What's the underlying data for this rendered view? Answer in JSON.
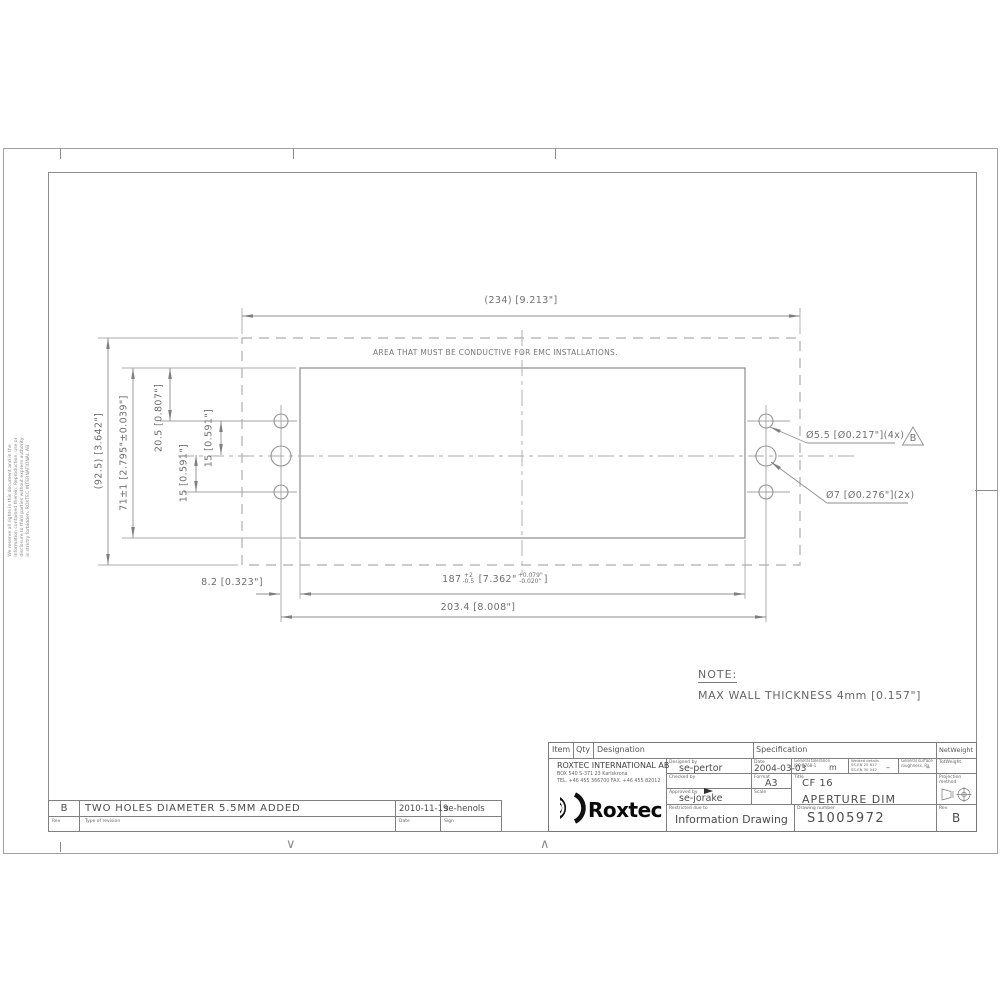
{
  "sheet": {
    "copyright": [
      "We reserve all rights in this document and in the",
      "information contained therein. Reproduction, use or",
      "disclosure to third parties without express authority",
      "is strictly forbidden.  ROXTEC INTERNATIONAL AB"
    ],
    "fold_mark_down": "∨",
    "fold_mark_up": "∧"
  },
  "drawing": {
    "emc_area_label": "AREA THAT MUST BE CONDUCTIVE FOR EMC INSTALLATIONS.",
    "dim_width_ref": "(234) [9.213\"]",
    "dim_height_ref": "(92.5) [3.642\"]",
    "dim_aperture_height": "71±1 [2.795\"±0.039\"]",
    "dim_hole_top_offset": "20.5 [0.807\"]",
    "dim_hole_pitch_upper": "15 [0.591\"]",
    "dim_hole_pitch_lower": "15 [0.591\"]",
    "dim_hole_edge": "8.2 [0.323\"]",
    "dim_aperture_width": {
      "main": "187",
      "plus": "+2",
      "minus": "-0.5",
      "inch": "[7.362\"",
      "inch_plus": "+0.079\"",
      "inch_minus": "-0.020\"",
      "close": "]"
    },
    "dim_hole_spacing": "203.4 [8.008\"]",
    "label_small_holes": "Ø5.5 [Ø0.217\"](4x)",
    "label_large_holes": "Ø7  [Ø0.276\"](2x)",
    "revision_flag": "B",
    "note_title": "NOTE:",
    "note_body": "MAX WALL THICKNESS  4mm [0.157\"]"
  },
  "revision_table": {
    "rev_value": "B",
    "description": "TWO HOLES DIAMETER 5.5MM ADDED",
    "date_value": "2010-11-19",
    "sign_value": "se-henols",
    "rev_label": "Rev",
    "type_label": "Type of revision",
    "date_label": "Date",
    "sign_label": "Sign"
  },
  "title_block": {
    "header_item": "Item",
    "header_qty": "Qty",
    "header_designation": "Designation",
    "header_specification": "Specification",
    "header_netweight": "NetWeight",
    "company_name": "ROXTEC INTERNATIONAL AB",
    "company_address": "BOX 540   S-371 23 Karlskrona",
    "company_phone": "TEL. +46 455 366700   FAX. +46 455 82012",
    "logo_text": "Roxtec",
    "designed_label": "Designed by",
    "designed_value": "se-pertor",
    "checked_label": "Checked by",
    "checked_value": "",
    "approved_label": "Approved by",
    "approved_value": "se-jorake",
    "restricted_label": "Restricted due to",
    "restricted_value": "Information Drawing",
    "date_label": "Date",
    "date_value": "2004-03-03",
    "format_label": "Format",
    "format_value": "A3",
    "scale_label": "Scale",
    "scale_value": "",
    "gentol_label1": "General tolerance",
    "gentol_label2": "ISO 2768-1",
    "gentol_value": "m",
    "weld_label1": "Welded details",
    "weld_label2": "SS-EN 25 817",
    "weld_label3": "SS-EN 30 042",
    "weld_value": "–",
    "surf_label1": "General surface",
    "surf_label2": "roughness, Ra",
    "surf_value": "–",
    "title_label": "Title",
    "title_line1": "CF 16",
    "title_line2": "APERTURE DIM",
    "drawingno_label": "Drawing number",
    "drawingno_value": "S1005972",
    "rev_label": "Rev",
    "rev_value": "B",
    "totweight_label": "TotWeight",
    "projection_label1": "Projection",
    "projection_label2": "method"
  }
}
